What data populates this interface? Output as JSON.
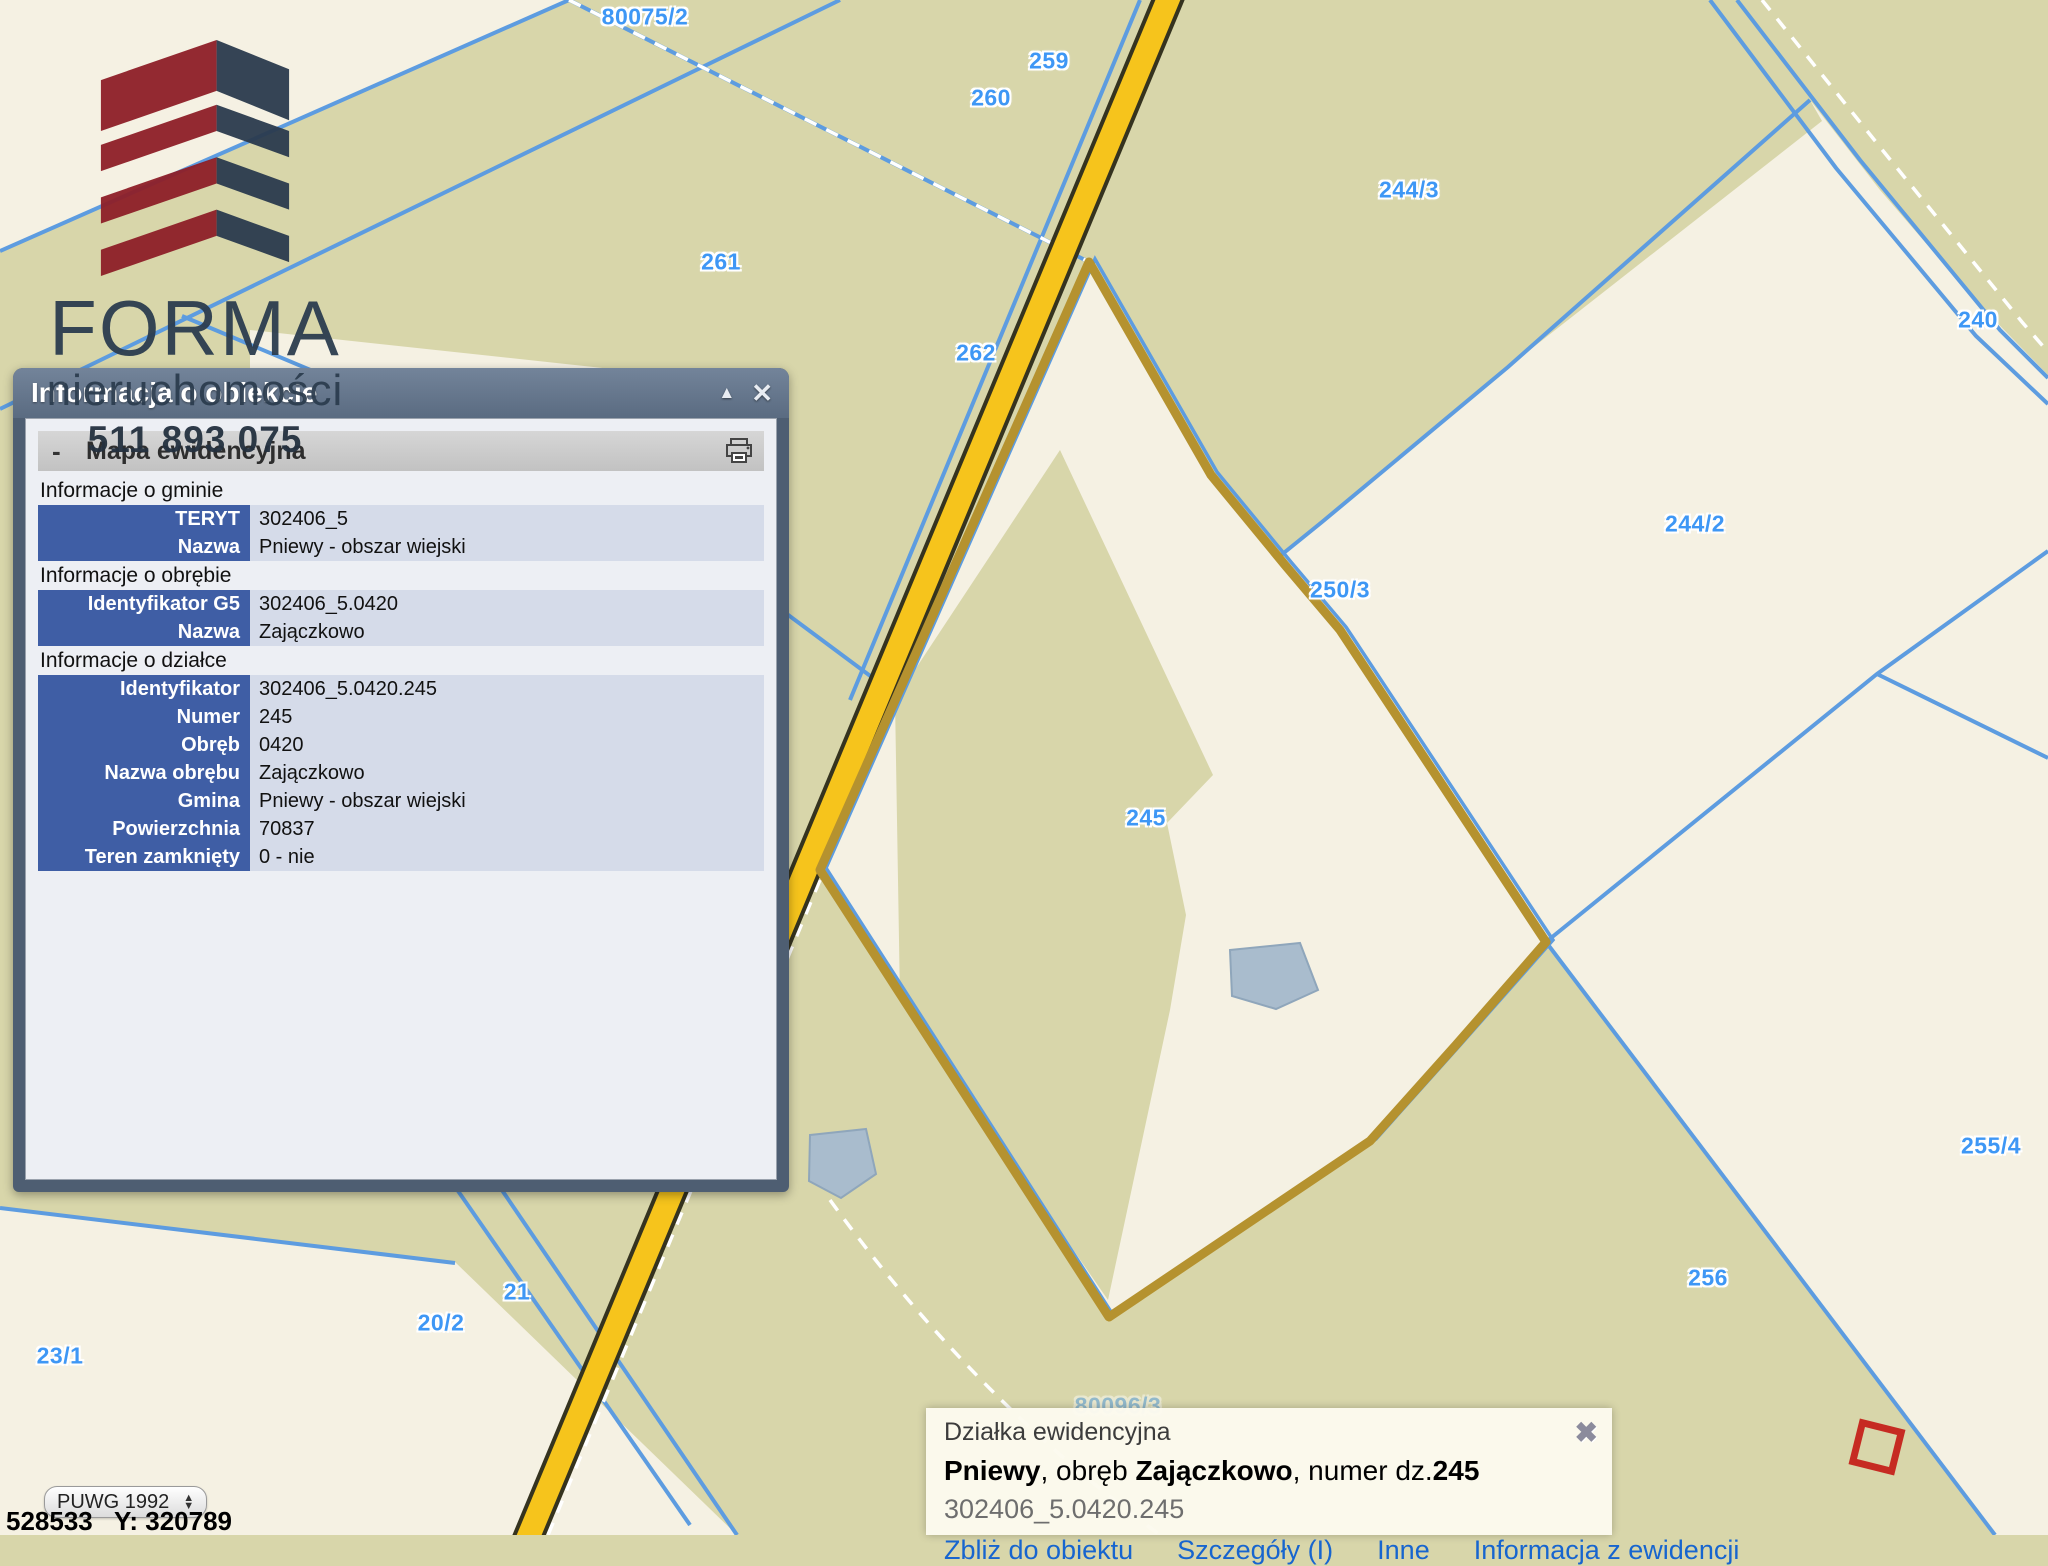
{
  "map": {
    "labels": [
      "80075/2",
      "259",
      "260",
      "261",
      "262",
      "244/3",
      "240",
      "244/2",
      "250/3",
      "245",
      "255/4",
      "256",
      "21",
      "20/2",
      "23/1",
      "80096/3"
    ]
  },
  "brand": {
    "name": "FORMA",
    "subtitle": "nieruchomości",
    "phone": "511 893 075"
  },
  "panel": {
    "title": "Informacja o obiekcie",
    "minimize_glyph": "▲",
    "close_glyph": "✕",
    "section": "Mapa ewidencyjna",
    "collapse_glyph": "-",
    "groups": [
      {
        "heading": "Informacje o gminie",
        "rows": [
          {
            "label": "TERYT",
            "value": "302406_5"
          },
          {
            "label": "Nazwa",
            "value": "Pniewy - obszar wiejski"
          }
        ]
      },
      {
        "heading": "Informacje o obrębie",
        "rows": [
          {
            "label": "Identyfikator G5",
            "value": "302406_5.0420"
          },
          {
            "label": "Nazwa",
            "value": "Zajączkowo"
          }
        ]
      },
      {
        "heading": "Informacje o działce",
        "rows": [
          {
            "label": "Identyfikator",
            "value": "302406_5.0420.245"
          },
          {
            "label": "Numer",
            "value": "245"
          },
          {
            "label": "Obręb",
            "value": "0420"
          },
          {
            "label": "Nazwa obrębu",
            "value": "Zajączkowo"
          },
          {
            "label": "Gmina",
            "value": "Pniewy - obszar wiejski"
          },
          {
            "label": "Powierzchnia",
            "value": "70837"
          },
          {
            "label": "Teren zamknięty",
            "value": "0 - nie"
          }
        ]
      }
    ]
  },
  "popup": {
    "header": "Działka ewidencyjna",
    "gmina": "Pniewy",
    "sep1": ", obręb ",
    "obreb": "Zajączkowo",
    "sep2": ", numer dz.",
    "numer": "245",
    "id": "302406_5.0420.245",
    "close_glyph": "✖",
    "links": [
      "Zbliż do obiektu",
      "Szczegóły (I)",
      "Inne",
      "Informacja z ewidencji"
    ]
  },
  "controls": {
    "projection": "PUWG 1992",
    "coordinates": "528533   Y: 320789"
  },
  "colors": {
    "map_olive": "#d8d6aa",
    "map_cream": "#f5f1e3",
    "road_fill": "#f6c41c",
    "road_casing": "#35331f",
    "parcel_outline_gold": "#b5922f",
    "boundary_blue": "#5d9ce0",
    "label_blue": "#3e97f5",
    "selected_marker_red": "#c62b22",
    "panel_label_bg": "#3f5ea5"
  }
}
